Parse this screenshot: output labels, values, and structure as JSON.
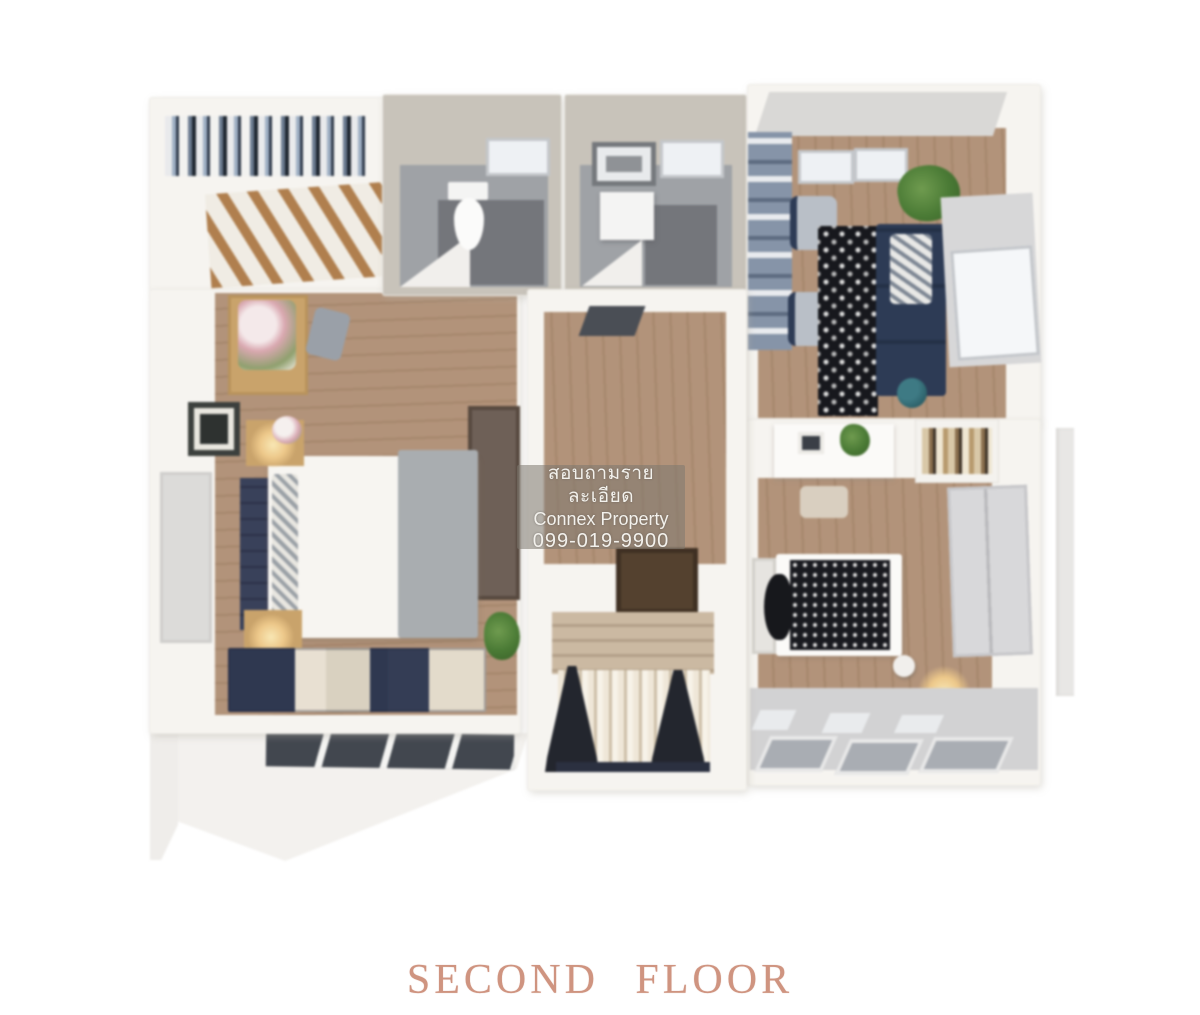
{
  "page": {
    "title": "SECOND FLOOR"
  },
  "watermark": {
    "line1": "สอบถามรายละเอียด",
    "line2": "Connex Property",
    "line3": "099-019-9900"
  },
  "palette": {
    "title_text": "#cf9480",
    "watermark_text": "#f3f1ec",
    "watermark_box": "rgba(125,120,112,0.55)",
    "wood_floor": "#b2937a",
    "wall_white": "#f6f4f0",
    "bathroom_wall": "#c8c3ba",
    "tile_light": "#9fa2a6",
    "tile_dark": "#74767b",
    "navy": "#2d3b55",
    "rug_black": "#17181d",
    "lamp_glow": "#edc88a",
    "stair_wood": "#cbb9a2"
  }
}
